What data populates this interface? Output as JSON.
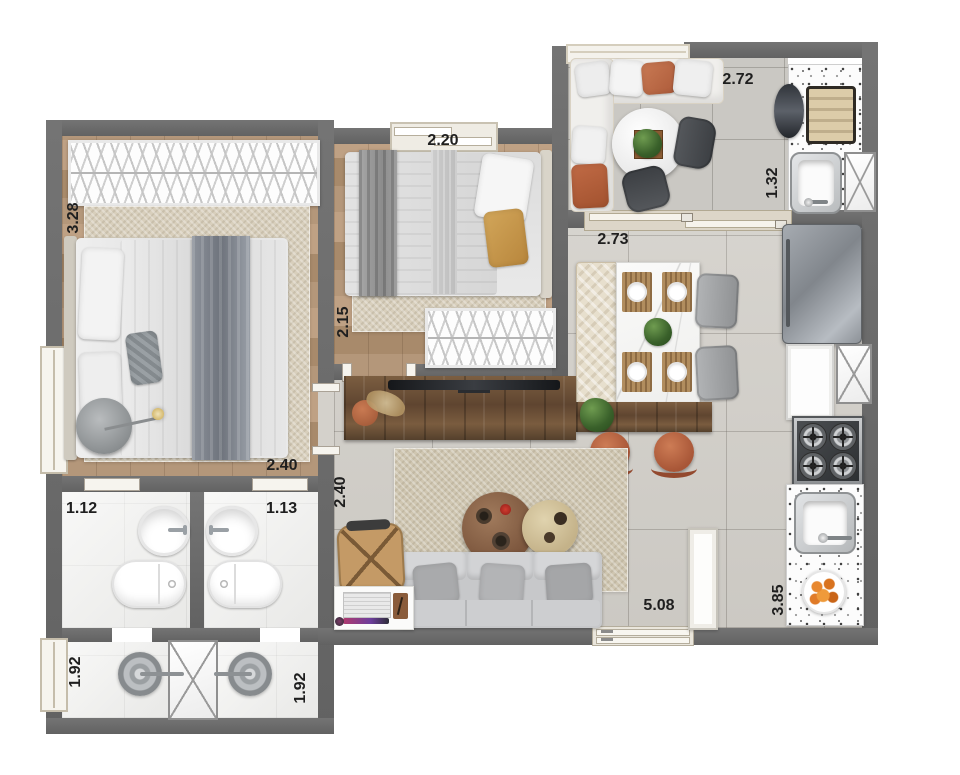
{
  "floor_plan": {
    "view": "apartment-top-view-render",
    "wall_color": "#6b6b6b",
    "labels": {
      "master_depth": "3.28",
      "master_width": "2.40",
      "bedroom2_width": "2.20",
      "bedroom2_depth": "2.15",
      "balcony_width": "2.72",
      "grill_counter_depth": "1.32",
      "dining_width": "2.73",
      "living_depth": "2.40",
      "living_width": "5.08",
      "kitchen_depth": "3.85",
      "bathroom1": "1.12",
      "bathroom2": "1.13",
      "shower1": "1.92",
      "shower2": "1.92"
    }
  }
}
